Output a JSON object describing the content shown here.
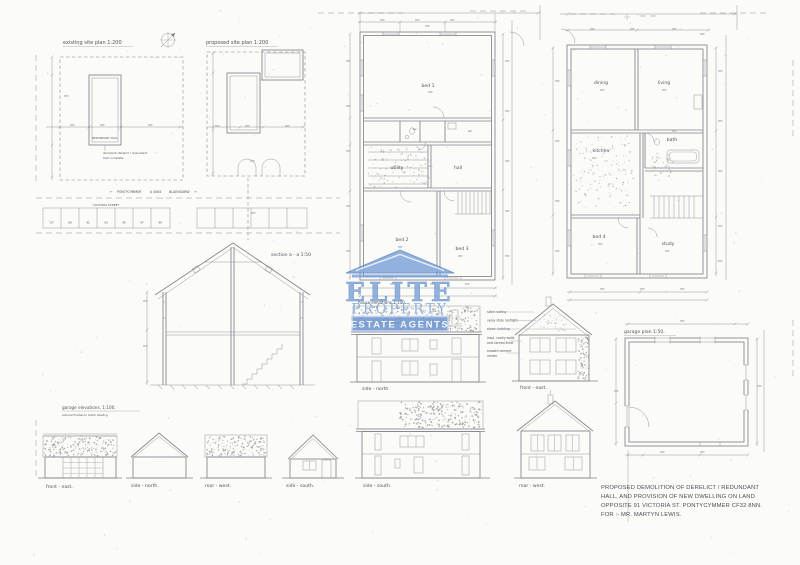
{
  "colors": {
    "paper": "#fbfbf8",
    "ink": "#84848e",
    "faint": "#b3b3bb",
    "label": "#55555e",
    "title_ink": "#4e4e57",
    "smudge": "#9a9aa2",
    "accent_blue": "#5b87c7",
    "watermark_fill": "#7fa5d9",
    "badge_fill": "#6a93cf"
  },
  "site": {
    "existing_title": "existing site plan 1:200",
    "proposed_title": "proposed site plan 1:200",
    "hall_label": "REDUNDANT HALL",
    "note_line1": "demolish derelict / redundant",
    "note_line2": "hall complete.",
    "arrow_left": "←",
    "arrow_right": "→",
    "road_left": "PONTYCYMMER",
    "road_ref": "A 4064",
    "road_right": "BLAENGARW",
    "street_name": "VICTORIA STREET",
    "house_numbers": [
      "87",
      "89",
      "91",
      "93",
      "95",
      "97",
      "99"
    ]
  },
  "section": {
    "title": "section a - a 1:50"
  },
  "plans": {
    "ground": {
      "bed1": "bed 1",
      "utility": "utility",
      "hall": "hall",
      "wc_left": "wc.",
      "wc_right": "wc",
      "bed2": "bed 2",
      "bed3": "bed 3"
    },
    "first": {
      "dining": "dining",
      "living": "living",
      "kitchen": "kitchen",
      "bath": "bath",
      "bed4": "bed 4",
      "study": "study"
    }
  },
  "elevations": {
    "house_title": "house elevations 1:100.",
    "mid_side_north": "side - north.",
    "mid_front_east": "front - east.",
    "bottom_side_south": "side - south.",
    "bottom_rear_west": "rear - west.",
    "annotations": [
      "slate roofing",
      "velux style rooflight",
      "stone cladding",
      "insul. cavity walls",
      "and vented lintel",
      "smooth cement",
      "render"
    ]
  },
  "garage": {
    "plan_title": "garage plan 1:50.",
    "elev_title": "garage elevations. 1:100.",
    "elev_note": "external finishes to match dwelling",
    "front_east": "front - east.",
    "side_north": "side - north.",
    "rear_west": "rear - west.",
    "side_south": "side - south."
  },
  "watermark": {
    "name": "ELITE",
    "tagline": "PROPERTY",
    "badge": "ESTATE AGENTS"
  },
  "title_block": {
    "line1": "PROPOSED DEMOLITION OF DERELICT / REDUNDANT",
    "line2": "HALL, AND PROVISION OF NEW DWELLING ON LAND",
    "line3": "OPPOSITE 91 VICTORIA ST. PONTYCYMMER CF32 8NN.",
    "line4": "FOR :- MR. MARTYN LEWIS."
  }
}
